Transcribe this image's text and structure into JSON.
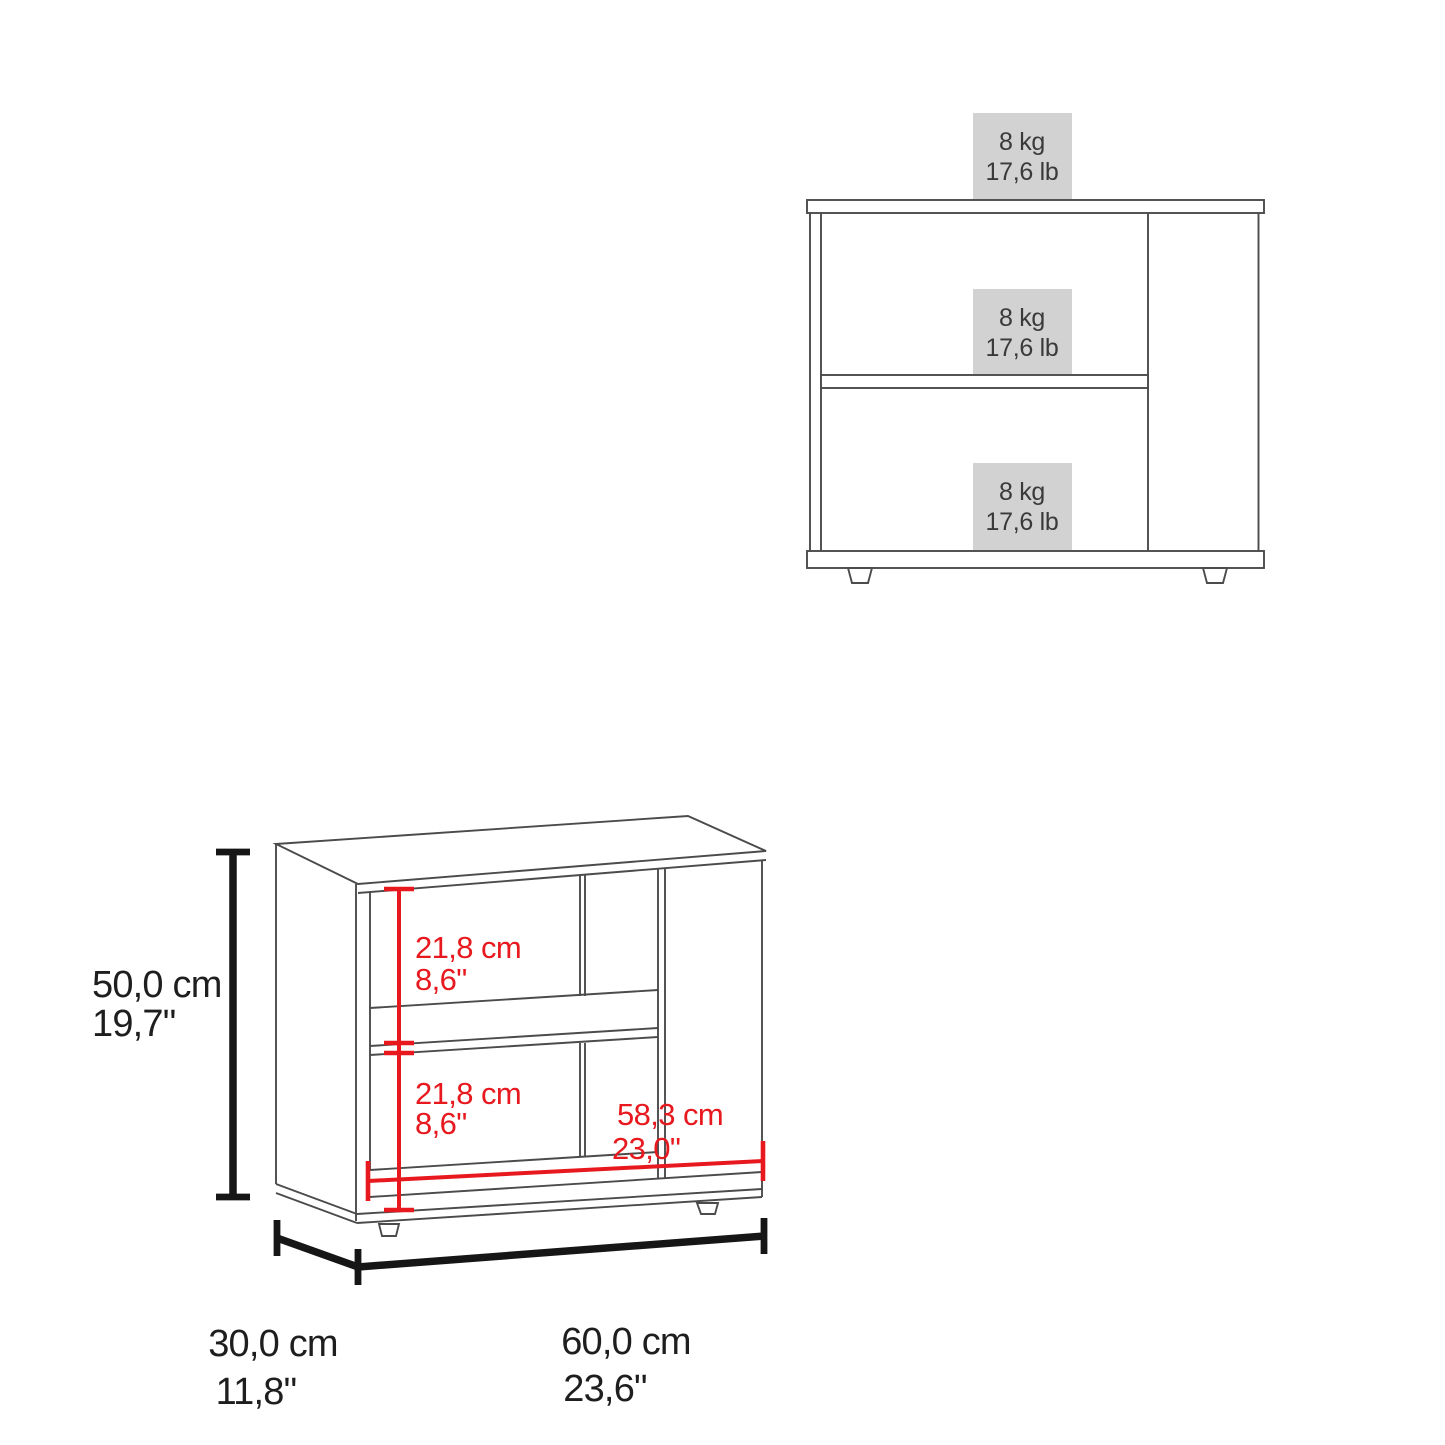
{
  "front_view": {
    "weight_labels": [
      {
        "kg": "8 kg",
        "lb": "17,6 lb"
      },
      {
        "kg": "8 kg",
        "lb": "17,6 lb"
      },
      {
        "kg": "8 kg",
        "lb": "17,6 lb"
      }
    ]
  },
  "perspective_view": {
    "height": {
      "cm": "50,0 cm",
      "in": "19,7\""
    },
    "depth": {
      "cm": "30,0 cm",
      "in": "11,8\""
    },
    "width": {
      "cm": "60,0 cm",
      "in": "23,6\""
    },
    "upper_shelf_space": {
      "cm": "21,8 cm",
      "in": "8,6\""
    },
    "lower_shelf_space": {
      "cm": "21,8 cm",
      "in": "8,6\""
    },
    "inner_width": {
      "cm": "58,3 cm",
      "in": "23,0\""
    }
  },
  "colors": {
    "accent_red": "#e8191e",
    "label_bg": "#d2d2d2",
    "line": "#4b4b4b",
    "dim_line": "#161616",
    "text_dark": "#1e1e1e",
    "weight_text": "#3a3a3a"
  }
}
